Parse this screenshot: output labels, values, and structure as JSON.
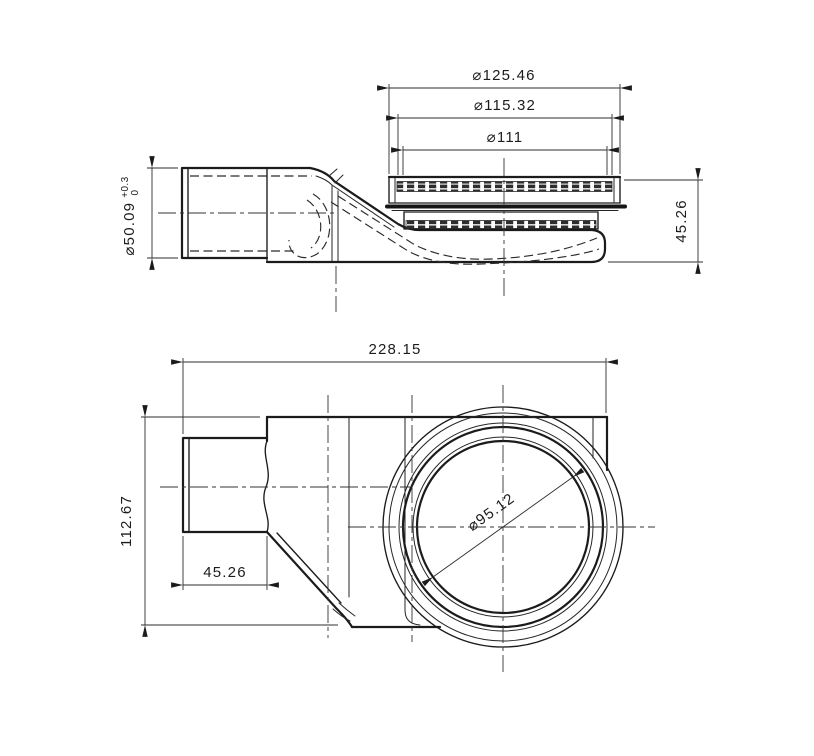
{
  "drawing": {
    "background": "#ffffff",
    "line_color": "#1b1b1b",
    "hatch_color": "#2e2e2e",
    "side_view": {
      "dim_dia_outer": "⌀125.46",
      "dim_dia_ring": "⌀115.32",
      "dim_dia_grate": "⌀111",
      "dim_height": "45.26",
      "dim_outlet_dia": "⌀50.09",
      "dim_outlet_tol_plus": "+0.3",
      "dim_outlet_tol_zero": "0"
    },
    "plan_view": {
      "dim_length": "228.15",
      "dim_width": "112.67",
      "dim_outlet_len": "45.26",
      "dim_bore_dia": "⌀95.12"
    }
  }
}
